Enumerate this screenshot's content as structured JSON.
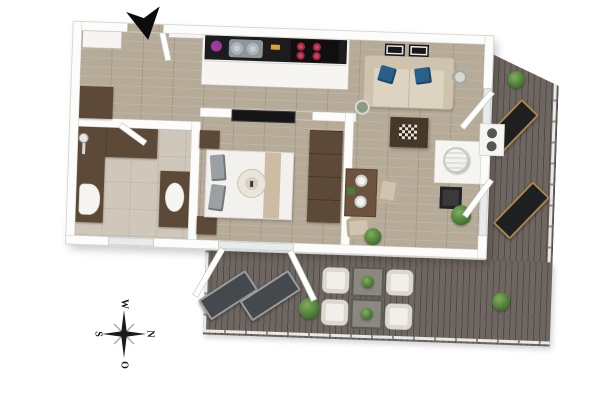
{
  "scene": {
    "type": "3d-floor-plan-render",
    "background": "#ffffff",
    "view": "top-down axonometric render of a one-bedroom apartment with L-shaped terrace"
  },
  "compass": {
    "west": "W",
    "south": "S",
    "north": "N",
    "east": "O"
  },
  "palette": {
    "wall": "#fbfbfa",
    "interior_wood_floor": "#b6aa98",
    "bathroom_tile": "#cfc7ba",
    "terrace_deck": "#6e6660",
    "dark_wood_furniture": "#5d4937",
    "sofa_beige": "#d6cbb7",
    "pillow_blue": "#27608a",
    "cooktop_burner_red": "#d03d55",
    "kitchen_pot_purple": "#a0399b",
    "lounger_black": "#1e1f21",
    "lounger_gray": "#45484c",
    "plant_green": "#4c7c39",
    "entrance_arrow_black": "#0c0c0c"
  },
  "rooms": [
    {
      "name": "hallway",
      "floor": "wood",
      "items": [
        "entrance-arrow",
        "entrance-door",
        "closet",
        "cabinet",
        "intercom-panel"
      ]
    },
    {
      "name": "bathroom",
      "floor": "tile",
      "items": [
        "shower-corner",
        "shower-fixture",
        "toilet",
        "vanity-sink",
        "window",
        "door"
      ]
    },
    {
      "name": "kitchen",
      "floor": "wood",
      "items": [
        "counter",
        "purple-pot",
        "double-sink",
        "cooktop-red-burners"
      ]
    },
    {
      "name": "bedroom",
      "floor": "wood",
      "items": [
        "double-bed",
        "gray-pillows",
        "bed-runner",
        "breakfast-tray",
        "nightstand-top",
        "nightstand-bottom",
        "wall-tv",
        "wardrobe",
        "open-terrace-door"
      ]
    },
    {
      "name": "living-room",
      "floor": "wood",
      "items": [
        "sofa",
        "blue-pillows",
        "picture-frames",
        "floor-lamp",
        "decor-sphere",
        "chess-coffee-table",
        "dining-table",
        "two-chairs",
        "pellet-stove",
        "stove-platform",
        "side-table",
        "potted-plants",
        "open-sliding-doors",
        "planter-box"
      ]
    },
    {
      "name": "terrace-right",
      "floor": "deck",
      "items": [
        "railing",
        "potted-plant",
        "sun-lounger",
        "sun-lounger"
      ]
    },
    {
      "name": "terrace-bottom",
      "floor": "deck",
      "items": [
        "railing",
        "sun-lounger",
        "sun-lounger",
        "potted-plant",
        "four-armchairs",
        "two-side-tables-with-plants",
        "potted-plant"
      ]
    }
  ]
}
